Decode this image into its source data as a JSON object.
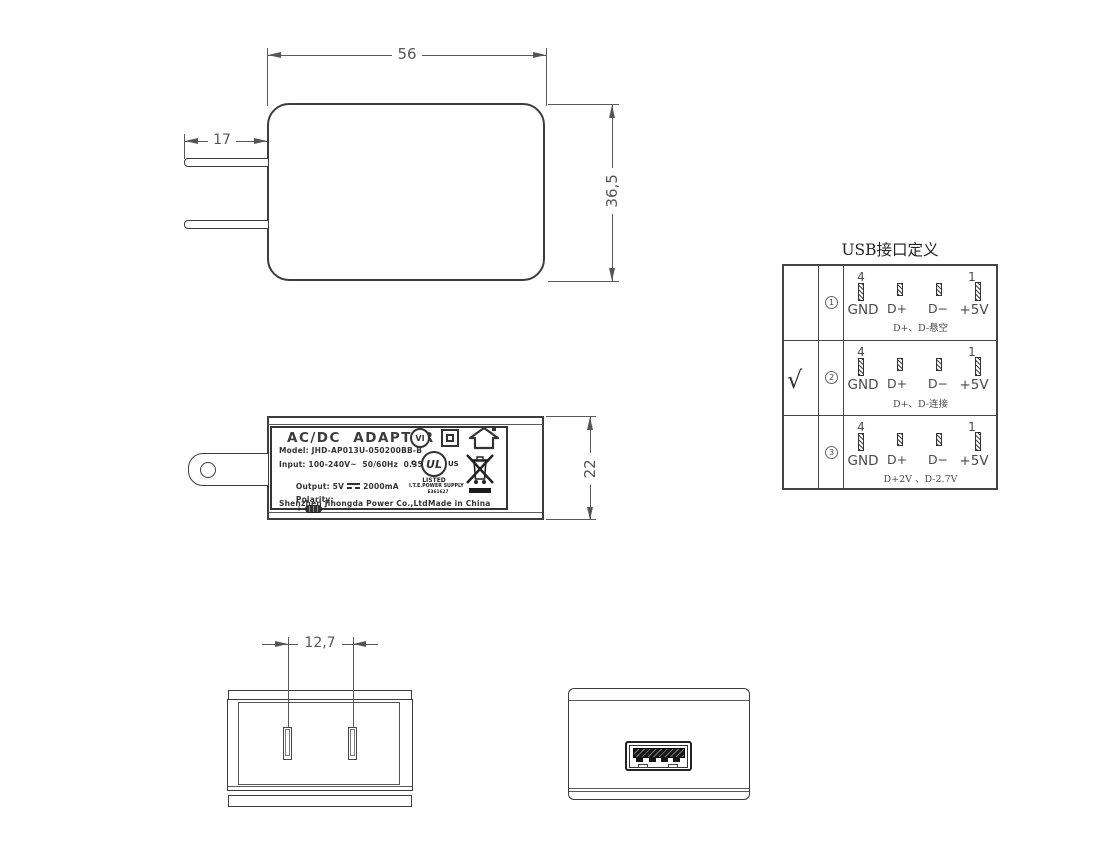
{
  "front_view": {
    "width_dim": "56",
    "height_dim": "36,5",
    "prong_dim": "17"
  },
  "side_view": {
    "height_dim": "22",
    "label": {
      "title": "AC/DC  ADAPTER",
      "model": "Model: JHD-AP013U-050200BB-B",
      "input": "Input: 100-240V~  50/60Hz  0.35A",
      "output_prefix": "Output: 5V",
      "output_suffix": "2000mA",
      "polarity_prefix": "Polarity:",
      "polarity_plus": "+",
      "polarity_minus": "−",
      "company": "Shenzhen Jihongda Power Co.,Ltd.",
      "made_in": "Made in China",
      "efficiency_mark": "VI",
      "ul_letters": "UL",
      "ul_c": "c",
      "ul_us": "US",
      "ul_listed": "LISTED",
      "ul_supply": "I.T.E.POWER SUPPLY",
      "ul_file": "E361627"
    }
  },
  "usb_table": {
    "title": "USB接口定义",
    "pin_top_left": "4",
    "pin_top_right": "1",
    "pin_labels": [
      "GND",
      "D+",
      "D−",
      "+5V"
    ],
    "rows": [
      {
        "num": "1",
        "checked": "",
        "note": "D+、D-悬空"
      },
      {
        "num": "2",
        "checked": "√",
        "note": "D+、D-连接"
      },
      {
        "num": "3",
        "checked": "",
        "note": "D+2V 、D-2.7V"
      }
    ]
  },
  "bottom_plug_view": {
    "prong_spacing_dim": "12,7"
  }
}
